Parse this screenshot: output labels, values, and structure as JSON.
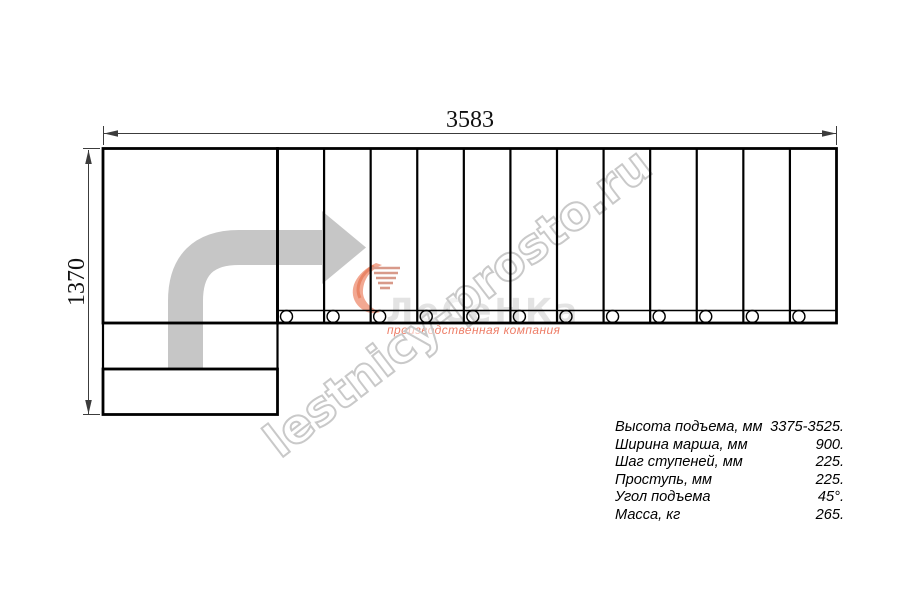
{
  "drawing": {
    "width_dimension": "3583",
    "height_dimension": "1370",
    "steps_count": 12
  },
  "specs": {
    "rows": [
      {
        "label": "Высота подъема, мм",
        "value": "3375-3525."
      },
      {
        "label": "Ширина марша, мм",
        "value": "900."
      },
      {
        "label": "Шаг ступеней, мм",
        "value": "225."
      },
      {
        "label": "Проступь, мм",
        "value": "225."
      },
      {
        "label": "Угол подъема",
        "value": "45°."
      },
      {
        "label": "Масса, кг",
        "value": "265."
      }
    ]
  },
  "watermark": {
    "site_text": "lestnicy-prosto.ru",
    "logo_text": "ЛеСеНКа",
    "logo_subtitle": "производственная компания"
  },
  "colors": {
    "line_color": "#000000",
    "dimension_color": "#3c3c3c",
    "arrow_grey": "#c6c6c6",
    "watermark_outline": "#c9c9c9",
    "logo_grey": "#e3e3e3",
    "logo_red": "#ee7e68"
  }
}
